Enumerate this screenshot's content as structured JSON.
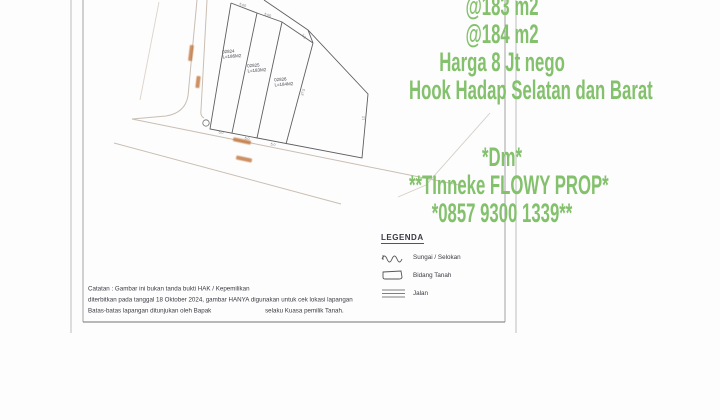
{
  "listing_overlay": {
    "text_color": "#84c16d",
    "header_lines": [
      "@183 m2",
      "@184 m2",
      "Harga 8 Jt nego",
      "Hook Hadap Selatan dan Barat"
    ],
    "contact_lines": [
      "*Dm*",
      "**TInneke FLOWY PROP*",
      "*0857 9300 1339**"
    ]
  },
  "survey_document": {
    "plots": [
      {
        "code": "02824",
        "area_label": "L=186M2"
      },
      {
        "code": "02825",
        "area_label": "L=183M2"
      },
      {
        "code": "02826",
        "area_label": "L=184M2"
      }
    ],
    "dimension_marks": [
      {
        "text": "5.00"
      },
      {
        "text": "5.00"
      },
      {
        "text": "2.0"
      },
      {
        "text": "5.0"
      },
      {
        "text": "5.0"
      },
      {
        "text": "5.0"
      },
      {
        "text": "37.5"
      },
      {
        "text": "12"
      }
    ],
    "legend": {
      "title": "LEGENDA",
      "items": [
        {
          "icon": "wavy-line",
          "label": "Sungai / Selokan"
        },
        {
          "icon": "parcel-outline",
          "label": "Bidang Tanah"
        },
        {
          "icon": "road-lines",
          "label": "Jalan"
        }
      ]
    },
    "notes": {
      "line1": "Catatan : Gambar ini bukan tanda bukti HAK / Kepemilikan",
      "line2": "diterbitkan pada tanggal 18 Oktober 2024, gambar HANYA digunakan untuk cek lokasi lapangan",
      "line3_left": "Batas-batas lapangan ditunjukan oleh Bapak",
      "line3_right": "selaku Kuasa pemilik Tanah."
    }
  },
  "palette": {
    "plan_line": "#5f5f63",
    "road_line": "#c9beb2",
    "orange_label": "#c0763d",
    "sheet_edge": "#bdbdbd"
  }
}
